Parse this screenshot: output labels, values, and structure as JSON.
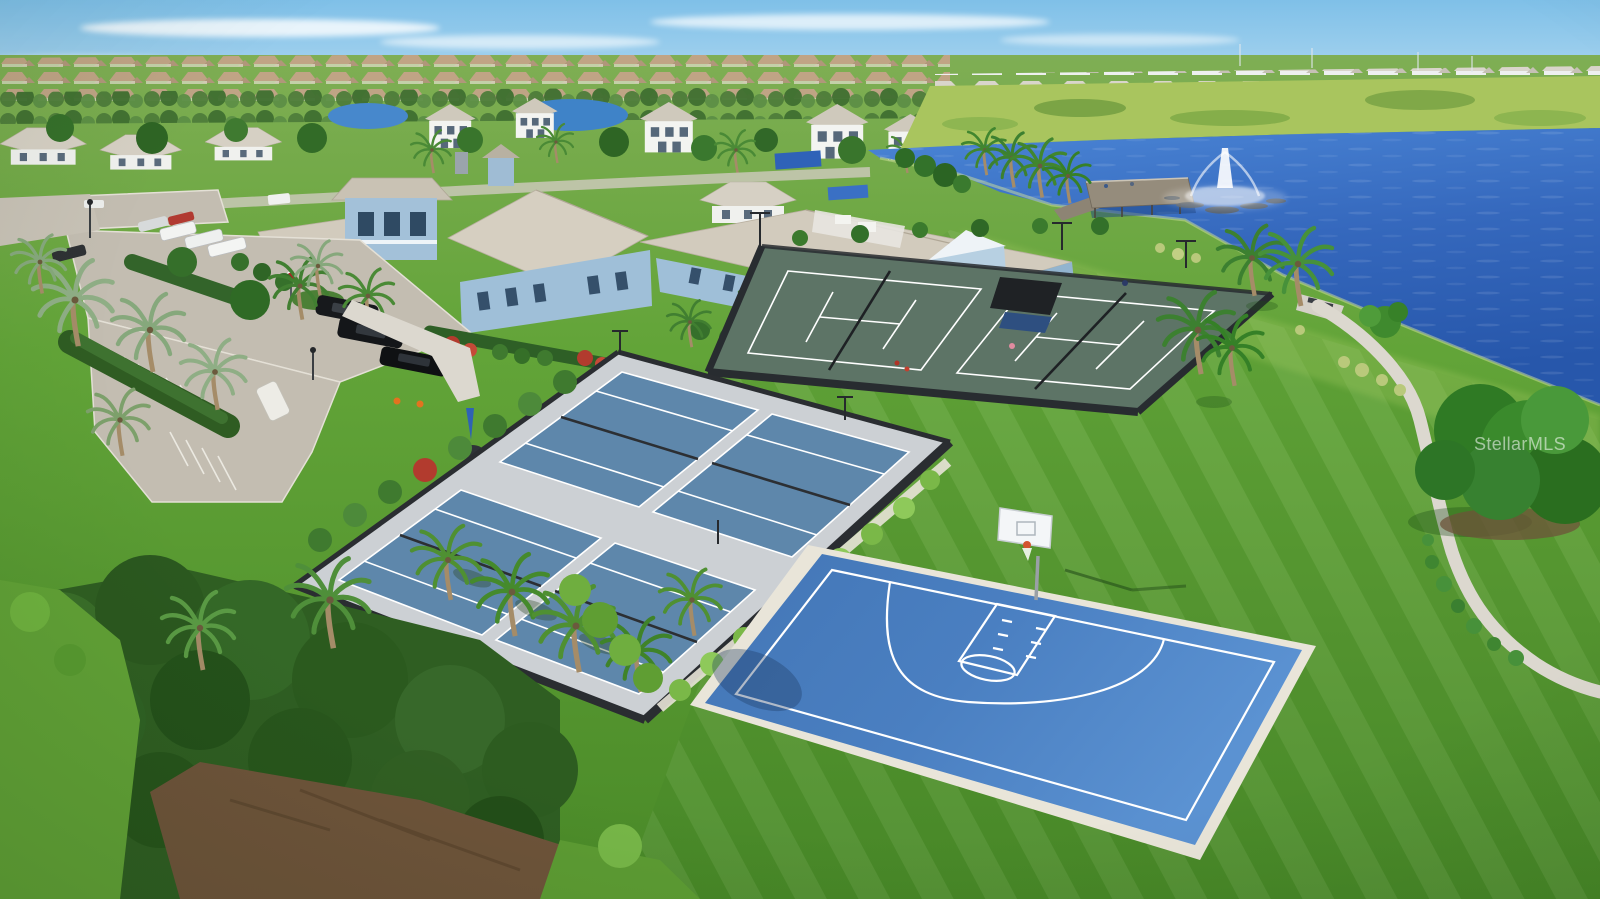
{
  "watermark": {
    "text": "StellarMLS"
  },
  "scene": {
    "type": "aerial-photograph",
    "subject": "Aerial view of a community amenity campus: four pickleball courts, two tennis courts with shade cabana, blue basketball half-court, light-blue clubhouse, paver parking lot with cars, lake with fountain and fishing pier, lawns, palms and a winding walking path",
    "amenities": [
      "pickleball courts (4)",
      "tennis courts (2)",
      "basketball half-court",
      "clubhouse",
      "parking lot",
      "lake fountain",
      "fishing pier",
      "walking path"
    ],
    "colors": {
      "sky_top": "#7fc0e8",
      "sky_horizon": "#dcEEf8",
      "lake_top": "#4b86d6",
      "lake_deep": "#2757ab",
      "marsh": "#a9c55e",
      "grass_light": "#7fae54",
      "grass_dark": "#4a8a28",
      "tennis_surface": "#5d7466",
      "pickleball_surface": "#5e87ab",
      "pickleball_apron": "#ccd0d4",
      "basketball_surface": "#4a7fc1",
      "court_line": "#ffffff",
      "fence": "#282c30",
      "roof": "#d2cbbd",
      "wall": "#a5c3da",
      "pavement": "#c3bdb1",
      "path": "#dcd8cf",
      "sand": "#e9e5d9"
    }
  }
}
